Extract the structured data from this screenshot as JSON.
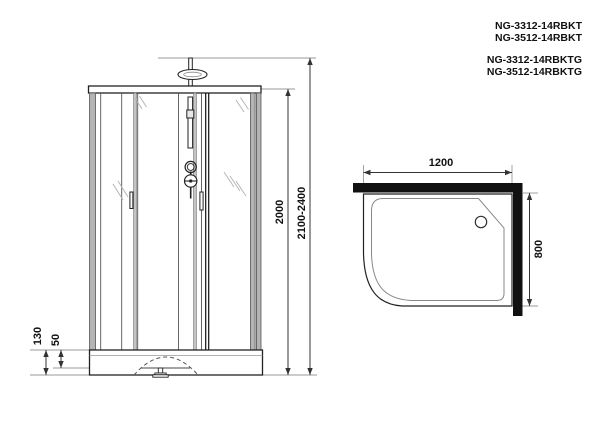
{
  "title": "Shower cabin technical drawing",
  "models": {
    "group1": [
      "NG-3312-14RBKT",
      "NG-3512-14RBKT"
    ],
    "group2": [
      "NG-3312-14RBKTG",
      "NG-3512-14RBKTG"
    ]
  },
  "front_view": {
    "glass_height": "2000",
    "total_height": "2100-2400",
    "tray_height": "130",
    "tray_step": "50"
  },
  "top_view": {
    "width": "1200",
    "depth": "800"
  },
  "colors": {
    "line": "#222222",
    "wall_fill": "#111111",
    "frame_gray": "#b4b4b4",
    "extension_line": "#999999",
    "background": "#ffffff"
  }
}
